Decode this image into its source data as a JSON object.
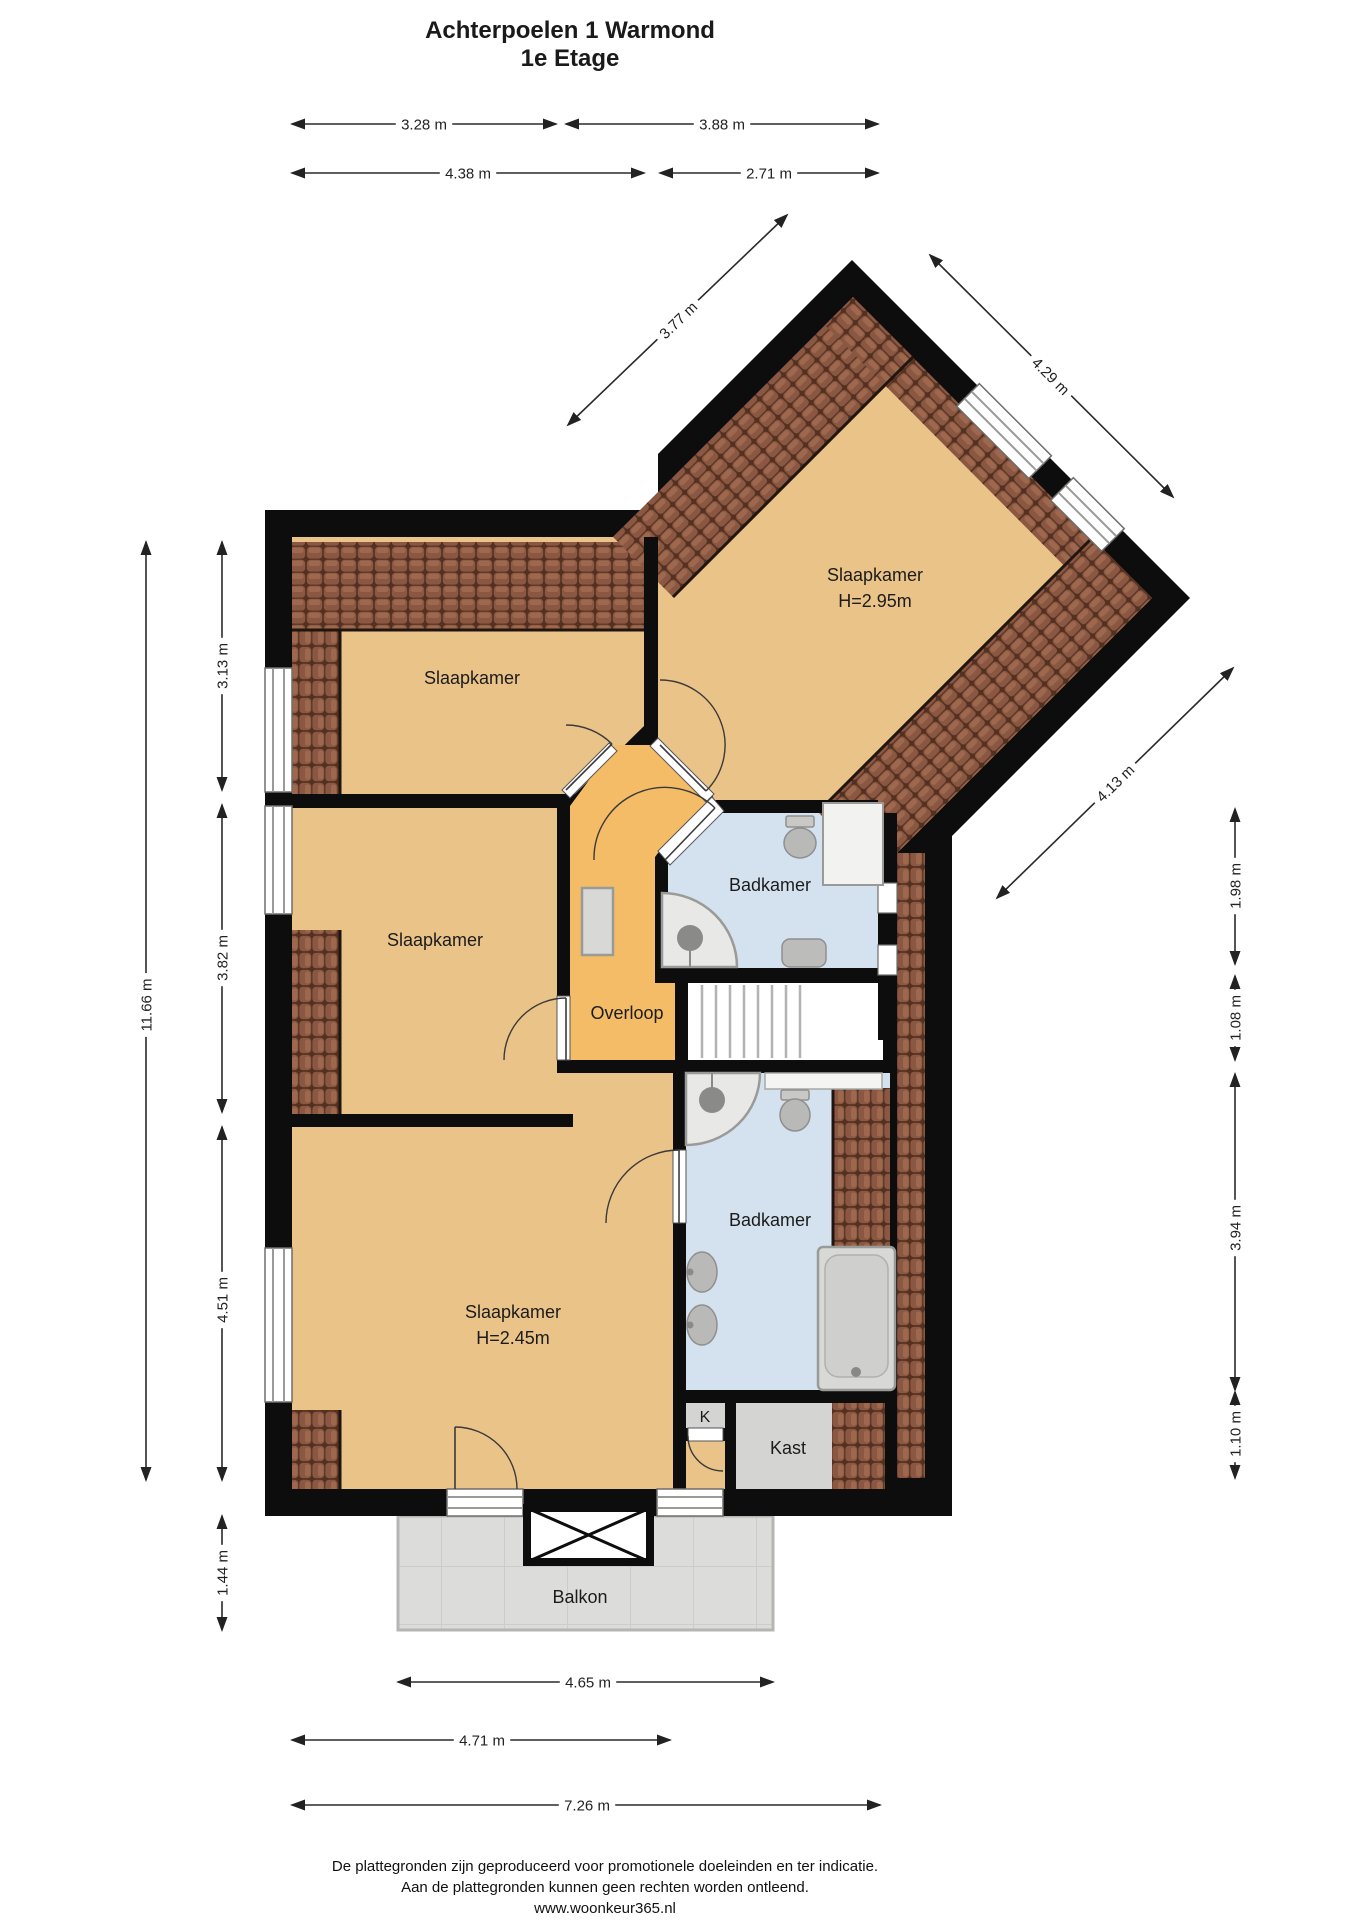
{
  "title": {
    "line1": "Achterpoelen 1  Warmond",
    "line2": "1e Etage"
  },
  "rooms": {
    "slaapkamer_topleft": "Slaapkamer",
    "slaapkamer_middle": "Slaapkamer",
    "slaapkamer_wing": "Slaapkamer",
    "slaapkamer_wing_height": "H=2.95m",
    "slaapkamer_bottom": "Slaapkamer",
    "slaapkamer_bottom_height": "H=2.45m",
    "badkamer_upper": "Badkamer",
    "badkamer_lower": "Badkamer",
    "overloop": "Overloop",
    "k_closet": "K",
    "kast": "Kast",
    "balkon": "Balkon"
  },
  "dimensions": [
    {
      "label": "3.28 m",
      "x1": 292,
      "y1": 124,
      "x2": 556,
      "y2": 124,
      "lx": 424,
      "ly": 124,
      "rot": 0
    },
    {
      "label": "3.88 m",
      "x1": 566,
      "y1": 124,
      "x2": 878,
      "y2": 124,
      "lx": 722,
      "ly": 124,
      "rot": 0
    },
    {
      "label": "4.38 m",
      "x1": 292,
      "y1": 173,
      "x2": 644,
      "y2": 173,
      "lx": 468,
      "ly": 173,
      "rot": 0
    },
    {
      "label": "2.71 m",
      "x1": 660,
      "y1": 173,
      "x2": 878,
      "y2": 173,
      "lx": 769,
      "ly": 173,
      "rot": 0
    },
    {
      "label": "3.77 m",
      "x1": 568,
      "y1": 425,
      "x2": 787,
      "y2": 215,
      "lx": 678,
      "ly": 320,
      "rot": -44
    },
    {
      "label": "4.29 m",
      "x1": 930,
      "y1": 255,
      "x2": 1173,
      "y2": 497,
      "lx": 1051,
      "ly": 376,
      "rot": 45
    },
    {
      "label": "4.13 m",
      "x1": 997,
      "y1": 898,
      "x2": 1233,
      "y2": 668,
      "lx": 1115,
      "ly": 783,
      "rot": -44
    },
    {
      "label": "11.66 m",
      "x1": 146,
      "y1": 542,
      "x2": 146,
      "y2": 1480,
      "lx": 146,
      "ly": 1005,
      "rot": -90
    },
    {
      "label": "3.13 m",
      "x1": 222,
      "y1": 542,
      "x2": 222,
      "y2": 790,
      "lx": 222,
      "ly": 666,
      "rot": -90
    },
    {
      "label": "3.82 m",
      "x1": 222,
      "y1": 805,
      "x2": 222,
      "y2": 1112,
      "lx": 222,
      "ly": 958,
      "rot": -90
    },
    {
      "label": "4.51 m",
      "x1": 222,
      "y1": 1127,
      "x2": 222,
      "y2": 1480,
      "lx": 222,
      "ly": 1300,
      "rot": -90
    },
    {
      "label": "1.44 m",
      "x1": 222,
      "y1": 1516,
      "x2": 222,
      "y2": 1630,
      "lx": 222,
      "ly": 1573,
      "rot": -90
    },
    {
      "label": "1.98 m",
      "x1": 1235,
      "y1": 809,
      "x2": 1235,
      "y2": 964,
      "lx": 1235,
      "ly": 886,
      "rot": -90
    },
    {
      "label": "1.08 m",
      "x1": 1235,
      "y1": 976,
      "x2": 1235,
      "y2": 1060,
      "lx": 1235,
      "ly": 1018,
      "rot": -90
    },
    {
      "label": "3.94 m",
      "x1": 1235,
      "y1": 1074,
      "x2": 1235,
      "y2": 1390,
      "lx": 1235,
      "ly": 1228,
      "rot": -90
    },
    {
      "label": "1.10 m",
      "x1": 1235,
      "y1": 1392,
      "x2": 1235,
      "y2": 1478,
      "lx": 1235,
      "ly": 1434,
      "rot": -90
    },
    {
      "label": "4.65 m",
      "x1": 398,
      "y1": 1682,
      "x2": 773,
      "y2": 1682,
      "lx": 588,
      "ly": 1682,
      "rot": 0
    },
    {
      "label": "4.71 m",
      "x1": 292,
      "y1": 1740,
      "x2": 670,
      "y2": 1740,
      "lx": 482,
      "ly": 1740,
      "rot": 0
    },
    {
      "label": "7.26 m",
      "x1": 292,
      "y1": 1805,
      "x2": 880,
      "y2": 1805,
      "lx": 587,
      "ly": 1805,
      "rot": 0
    }
  ],
  "footer": {
    "line1": "De plattegronden zijn geproduceerd voor promotionele doeleinden en ter indicatie.",
    "line2": "Aan de plattegronden kunnen geen rechten worden ontleend.",
    "line3": "www.woonkeur365.nl"
  },
  "colors": {
    "wall": "#0d0d0d",
    "bedroom": "#eac388",
    "hallway": "#f4bc66",
    "bathroom": "#d4e2ef",
    "closet": "#d4d4d2",
    "balcony": "#dcdcda",
    "tile_base": "#53301f",
    "tile_face": "#8a5742",
    "tile_light": "#a06b50"
  }
}
